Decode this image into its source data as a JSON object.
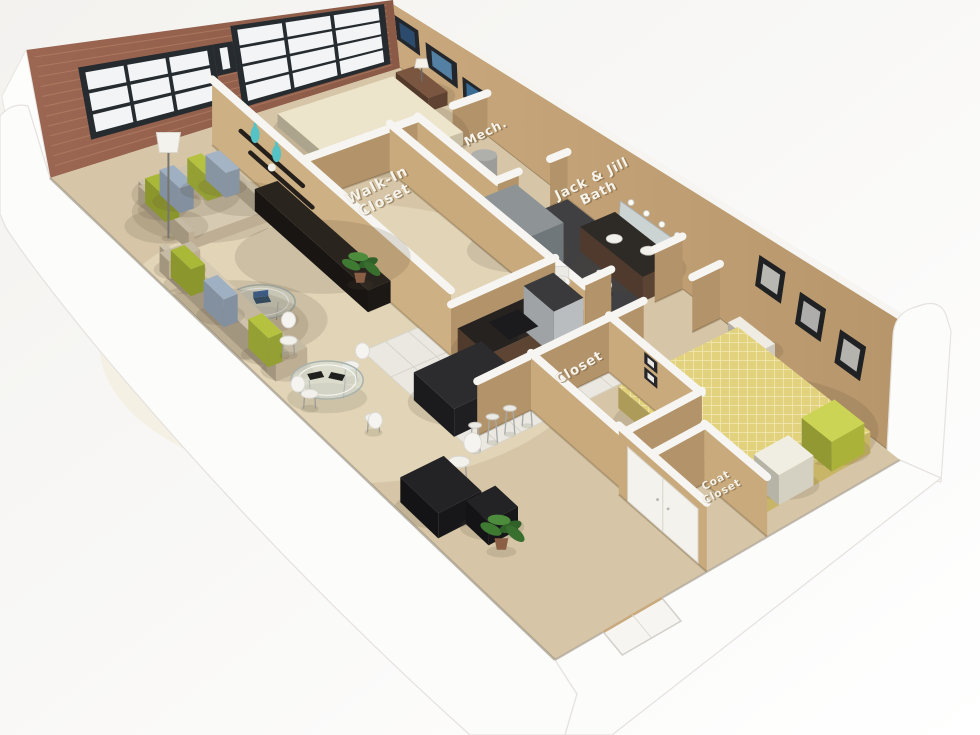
{
  "labels": [
    {
      "id": "walk-in-closet",
      "lines": [
        "Walk-In",
        "Closet"
      ],
      "u": 0.545,
      "v": 0.275,
      "rot": -27,
      "size": 14.5,
      "lift": 1.0
    },
    {
      "id": "mech",
      "lines": [
        "Mech."
      ],
      "u": 0.885,
      "v": 0.255,
      "rot": -27,
      "size": 12.5,
      "lift": 1.0
    },
    {
      "id": "jack-and-jill-bath",
      "lines": [
        "Jack & Jill",
        "Bath"
      ],
      "u": 0.96,
      "v": 0.415,
      "rot": -26,
      "size": 13.5,
      "lift": 1.05
    },
    {
      "id": "closet",
      "lines": [
        "Closet"
      ],
      "u": 0.505,
      "v": 0.705,
      "rot": -30,
      "size": 13.5,
      "lift": 1.0
    },
    {
      "id": "coat-closet",
      "lines": [
        "Coat",
        "Closet"
      ],
      "u": 0.565,
      "v": 0.935,
      "rot": -28,
      "size": 10.5,
      "lift": 0.55
    }
  ],
  "palette": {
    "bg_a": "#f3f2ef",
    "bg_b": "#ffffff",
    "brick_a": "#9c6752",
    "brick_b": "#8a5a46",
    "mortar": "rgba(193,142,112,0.45)",
    "window_frame": "#262b2f",
    "window_pane": "#f2f4f5",
    "ne_wall_a": "#c8a87c",
    "ne_wall_b": "#b6956a",
    "wall_face_light": "#c9aa7d",
    "wall_face_dark": "#b3936a",
    "wall_cap": "#f6f5f1",
    "carpet": "#d6c6a7",
    "carpet_light": "#e6d8b8",
    "tile": "#eae8e1",
    "tile_line": "#d7d4c9",
    "bath_floor": "#403f42",
    "white_band": "#fcfcfb",
    "band_edge": "#e6e3df",
    "cabinet": "#5d4433",
    "counter": "#262220",
    "steel": "#b9bdc0",
    "sofa_top": "#d6cab2",
    "sofa_side": "#bdae94",
    "pillow_green": "#a9b837",
    "pillow_gray": "#9fb0c2",
    "bed1_top": "#ece4cb",
    "bed2_top": "#e2d27e",
    "desk": "#232326",
    "plant": "#3f7a33",
    "vase_teal": "#55c2c5",
    "label_fill": "#f6f3ea",
    "label_shadow": "rgba(120,95,60,0.55)"
  },
  "corners": {
    "W": [
      50,
      178
    ],
    "N": [
      400,
      68
    ],
    "E": [
      900,
      460
    ],
    "S": [
      555,
      660
    ]
  },
  "brick_windows": [
    {
      "t1": 0.13,
      "t2": 0.5,
      "s1": 0.2,
      "s2": 0.8,
      "cols": 3,
      "rows": 3
    },
    {
      "t1": 0.555,
      "t2": 0.975,
      "s1": 0.1,
      "s2": 0.96,
      "cols": 3,
      "rows": 4
    },
    {
      "t1": 0.5,
      "t2": 0.555,
      "s1": 0.48,
      "s2": 0.8,
      "cols": 1,
      "rows": 1
    }
  ],
  "ne_art": {
    "bedroom1_frames": [
      {
        "t1": 0.0,
        "t2": 0.045,
        "s1": 0.42,
        "s2": 0.78,
        "art": "#2c4a6b"
      },
      {
        "t1": 0.058,
        "t2": 0.118,
        "s1": 0.34,
        "s2": 0.68,
        "art": "#5380a3"
      },
      {
        "t1": 0.128,
        "t2": 0.168,
        "s1": 0.28,
        "s2": 0.55,
        "art": "#3a6b92"
      }
    ],
    "bedroom2_frames": [
      {
        "t1": 0.695,
        "t2": 0.745,
        "s1": 0.5,
        "s2": 0.78,
        "art": "#b8b7b2"
      },
      {
        "t1": 0.775,
        "t2": 0.825,
        "s1": 0.42,
        "s2": 0.7,
        "art": "#aeadab"
      },
      {
        "t1": 0.855,
        "t2": 0.905,
        "s1": 0.34,
        "s2": 0.62,
        "art": "#b4b3ae"
      }
    ],
    "mirror": {
      "t1": 0.435,
      "t2": 0.555,
      "s1": 0.1,
      "s2": 0.4
    },
    "bulbs": {
      "s": 0.46,
      "t_start": 0.455,
      "t_end": 0.545,
      "count": 4
    }
  },
  "walls": [
    {
      "id": "tv-wall",
      "u1": 0.42,
      "v1": 0.03,
      "u2": 0.42,
      "v2": 0.505,
      "h": 72,
      "face": "#cdb083",
      "shelves": [
        {
          "t1": 0.12,
          "t2": 0.38,
          "s": 0.6
        },
        {
          "t1": 0.16,
          "t2": 0.42,
          "s": 0.4
        }
      ],
      "vases": [
        {
          "t": 0.18,
          "s": 0.6
        },
        {
          "t": 0.27,
          "s": 0.6
        }
      ],
      "ball": {
        "t": 0.25,
        "s": 0.4
      }
    },
    {
      "id": "bedroom1-wall-a",
      "u1": 0.42,
      "v1": 0.175,
      "u2": 0.8,
      "v2": 0.175,
      "h": 50
    },
    {
      "id": "bedroom1-wall-b",
      "u1": 0.9,
      "v1": 0.175,
      "u2": 1.0,
      "v2": 0.175,
      "h": 50
    },
    {
      "id": "mech-wall-west",
      "u1": 0.8,
      "v1": 0.175,
      "u2": 0.8,
      "v2": 0.335,
      "h": 50
    },
    {
      "id": "mech-wall-south-a",
      "u1": 0.8,
      "v1": 0.335,
      "u2": 0.86,
      "v2": 0.335,
      "h": 50
    },
    {
      "id": "mech-wall-south-b",
      "u1": 0.95,
      "v1": 0.335,
      "u2": 1.0,
      "v2": 0.335,
      "h": 50
    },
    {
      "id": "closet-wall-east",
      "u1": 0.72,
      "v1": 0.175,
      "u2": 0.72,
      "v2": 0.565,
      "h": 50
    },
    {
      "id": "kitchen-wall",
      "u1": 0.42,
      "v1": 0.505,
      "u2": 0.72,
      "v2": 0.505,
      "h": 50
    },
    {
      "id": "bath-wall-south-a",
      "u1": 0.72,
      "v1": 0.565,
      "u2": 0.795,
      "v2": 0.565,
      "h": 50
    },
    {
      "id": "bath-wall-south-b",
      "u1": 0.92,
      "v1": 0.565,
      "u2": 1.0,
      "v2": 0.565,
      "h": 50
    },
    {
      "id": "hall-stub-wall",
      "u1": 0.3,
      "v1": 0.64,
      "u2": 0.455,
      "v2": 0.64,
      "h": 50
    },
    {
      "id": "hall-closet-wall-north",
      "u1": 0.455,
      "v1": 0.64,
      "u2": 0.68,
      "v2": 0.64,
      "h": 50
    },
    {
      "id": "hall-closet-wall-east",
      "u1": 0.68,
      "v1": 0.64,
      "u2": 0.68,
      "v2": 0.825,
      "h": 50,
      "frames": [
        {
          "t1": 0.38,
          "t2": 0.52,
          "s1": 0.42,
          "s2": 0.62
        },
        {
          "t1": 0.38,
          "t2": 0.52,
          "s1": 0.68,
          "s2": 0.88
        }
      ]
    },
    {
      "id": "hall-closet-wall-west",
      "u1": 0.455,
      "v1": 0.64,
      "u2": 0.455,
      "v2": 0.825,
      "h": 50
    },
    {
      "id": "hall-closet-wall-south",
      "u1": 0.455,
      "v1": 0.825,
      "u2": 0.68,
      "v2": 0.825,
      "h": 50
    },
    {
      "id": "bedroom2-wall-north-a",
      "u1": 0.68,
      "v1": 0.64,
      "u2": 0.78,
      "v2": 0.64,
      "h": 50
    },
    {
      "id": "bedroom2-wall-north-b",
      "u1": 0.92,
      "v1": 0.64,
      "u2": 1.0,
      "v2": 0.64,
      "h": 50
    },
    {
      "id": "bedroom2-wall-west",
      "u1": 0.44,
      "v1": 0.825,
      "u2": 0.44,
      "v2": 1.0,
      "h": 56,
      "doors": "double"
    },
    {
      "id": "coat-closet-wall-north",
      "u1": 0.46,
      "v1": 0.875,
      "u2": 0.615,
      "v2": 0.875,
      "h": 48
    },
    {
      "id": "coat-closet-wall-east",
      "u1": 0.615,
      "v1": 0.875,
      "u2": 0.615,
      "v2": 1.0,
      "h": 48
    }
  ],
  "furniture": [
    {
      "id": "bed1",
      "type": "box",
      "u1": 0.6,
      "v1": 0.035,
      "u2": 0.93,
      "v2": 0.175,
      "h": 16,
      "top": "#ece4cb",
      "side": "#c9bfa4"
    },
    {
      "id": "bed1-pillow-a",
      "type": "box",
      "u1": 0.845,
      "v1": 0.045,
      "u2": 0.915,
      "v2": 0.1,
      "h": 22,
      "top": "#b8c63d",
      "side": "#9aa82e"
    },
    {
      "id": "bed1-pillow-b",
      "type": "box",
      "u1": 0.845,
      "v1": 0.11,
      "u2": 0.915,
      "v2": 0.165,
      "h": 22,
      "top": "#cdd34f",
      "side": "#aab23a"
    },
    {
      "id": "nightstand1",
      "type": "box",
      "u1": 0.945,
      "v1": 0.03,
      "u2": 1.0,
      "v2": 0.095,
      "h": 17,
      "top": "#7a5640",
      "side": "#5f4231",
      "lampTop": true
    },
    {
      "id": "tv-console",
      "type": "box",
      "u1": 0.355,
      "v1": 0.16,
      "u2": 0.42,
      "v2": 0.385,
      "h": 24,
      "top": "#2a241f",
      "side": "#1c1815"
    },
    {
      "id": "console-ball",
      "type": "flatCircle",
      "u": 0.4,
      "v": 0.19,
      "r": 4.5,
      "liftpx": 30,
      "fill": "#f2f0ea"
    },
    {
      "id": "sofa-long",
      "type": "sofa",
      "u1": 0.13,
      "v1": 0.085,
      "u2": 0.37,
      "v2": 0.185,
      "h": 14,
      "backside": "v1",
      "top": "#d6cab2",
      "side": "#bdae94",
      "pillows": [
        {
          "u": 0.165,
          "v": 0.108,
          "c": "#a9b837"
        },
        {
          "u": 0.215,
          "v": 0.102,
          "c": "#9fb0c2"
        },
        {
          "u": 0.3,
          "v": 0.098,
          "c": "#b4c23f"
        },
        {
          "u": 0.345,
          "v": 0.103,
          "c": "#a5b4c4"
        }
      ]
    },
    {
      "id": "sofa-side",
      "type": "sofa",
      "u1": 0.025,
      "v1": 0.2,
      "u2": 0.115,
      "v2": 0.43,
      "h": 14,
      "backside": "u1",
      "top": "#d6cab2",
      "side": "#bdae94",
      "pillows": [
        {
          "u": 0.055,
          "v": 0.235,
          "c": "#a9b837"
        },
        {
          "u": 0.055,
          "v": 0.3,
          "c": "#9fb0c2"
        },
        {
          "u": 0.06,
          "v": 0.385,
          "c": "#b4c23f"
        }
      ]
    },
    {
      "id": "floor-lamp",
      "type": "lamp",
      "u": 0.115,
      "v": 0.155
    },
    {
      "id": "coffee-table",
      "type": "glassRound",
      "u": 0.135,
      "v": 0.325,
      "rx": 34,
      "ry": 17,
      "laptop": true
    },
    {
      "id": "living-plant",
      "type": "plant",
      "u": 0.405,
      "v": 0.335,
      "s": 1.0
    },
    {
      "id": "dining-table",
      "type": "glassRound",
      "u": 0.1,
      "v": 0.48,
      "rx": 36,
      "ry": 19,
      "mats": true
    },
    {
      "id": "dining-chair-n",
      "type": "chair",
      "u": 0.105,
      "v": 0.4,
      "back": [
        0,
        -14
      ]
    },
    {
      "id": "dining-chair-e",
      "type": "chair",
      "u": 0.175,
      "v": 0.475,
      "back": [
        13,
        -7
      ]
    },
    {
      "id": "dining-chair-s",
      "type": "chair",
      "u": 0.11,
      "v": 0.565,
      "back": [
        2,
        12
      ]
    },
    {
      "id": "dining-chair-w",
      "type": "chair",
      "u": 0.035,
      "v": 0.49,
      "back": [
        -13,
        -2
      ]
    },
    {
      "id": "kitchen-cabinets",
      "type": "box",
      "u1": 0.425,
      "v1": 0.515,
      "u2": 0.7,
      "v2": 0.575,
      "h": 30,
      "top": "#262220",
      "side": "#5d4433",
      "k": -0.05
    },
    {
      "id": "oven-tower",
      "type": "box",
      "u1": 0.615,
      "v1": 0.515,
      "u2": 0.7,
      "v2": 0.575,
      "h": 42,
      "top": "#3a3a3c",
      "side": "#b9bdc0",
      "k": -0.045
    },
    {
      "id": "cooktop",
      "type": "flatQuad",
      "u1": 0.5,
      "v1": 0.525,
      "u2": 0.585,
      "v2": 0.565,
      "liftpx": 30,
      "fill": "#1b1b1d",
      "k": -0.04
    },
    {
      "id": "island-bar",
      "type": "box",
      "u1": 0.255,
      "v1": 0.545,
      "u2": 0.45,
      "v2": 0.625,
      "h": 26,
      "top": "#2c2c2f",
      "side": "#1f1f22"
    },
    {
      "id": "stool-1",
      "type": "stool",
      "u": 0.265,
      "v": 0.66
    },
    {
      "id": "stool-2",
      "type": "stool",
      "u": 0.315,
      "v": 0.66
    },
    {
      "id": "stool-3",
      "type": "stool",
      "u": 0.365,
      "v": 0.66
    },
    {
      "id": "stool-4",
      "type": "stool",
      "u": 0.415,
      "v": 0.66
    },
    {
      "id": "shower",
      "type": "box",
      "u1": 0.725,
      "v1": 0.34,
      "u2": 0.845,
      "v2": 0.435,
      "h": 40,
      "top": "#8e9496",
      "side": "#70777a"
    },
    {
      "id": "toilet-1",
      "type": "toilet",
      "u": 0.775,
      "v": 0.48
    },
    {
      "id": "toilet-2",
      "type": "toilet",
      "u": 0.845,
      "v": 0.515
    },
    {
      "id": "bath-vanity",
      "type": "box",
      "u1": 0.9,
      "v1": 0.43,
      "u2": 1.0,
      "v2": 0.555,
      "h": 24,
      "top": "#2e2a26",
      "side": "#5c4434",
      "sinks": true
    },
    {
      "id": "water-heater",
      "type": "cyl",
      "u": 0.89,
      "v": 0.245,
      "r": 13,
      "h": 26,
      "fill": "#9c9c9a"
    },
    {
      "id": "bed2",
      "type": "box",
      "u1": 0.62,
      "v1": 0.7,
      "u2": 0.965,
      "v2": 0.965,
      "h": 18,
      "top": "pattern",
      "side": "#c9b568"
    },
    {
      "id": "bed2-pillow-a",
      "type": "box",
      "u1": 0.86,
      "v1": 0.9,
      "u2": 0.955,
      "v2": 0.96,
      "h": 24,
      "top": "#ccd455",
      "side": "#aab23a",
      "k": 0.2
    },
    {
      "id": "bed2-pillow-b",
      "type": "box",
      "u1": 0.7,
      "v1": 0.915,
      "u2": 0.8,
      "v2": 0.965,
      "h": 24,
      "top": "#f0eee2",
      "side": "#d4d1c2",
      "k": 0.2
    },
    {
      "id": "nightstand2",
      "type": "box",
      "u1": 0.965,
      "v1": 0.68,
      "u2": 1.0,
      "v2": 0.75,
      "h": 16,
      "top": "#efece4",
      "side": "#cfc9bd"
    },
    {
      "id": "desk",
      "type": "box",
      "u1": 0.02,
      "v1": 0.68,
      "u2": 0.145,
      "v2": 0.755,
      "h": 22,
      "top": "#232326",
      "side": "#17171a"
    },
    {
      "id": "desk-return",
      "type": "box",
      "u1": 0.1,
      "v1": 0.755,
      "u2": 0.185,
      "v2": 0.8,
      "h": 20,
      "top": "#232326",
      "side": "#17171a"
    },
    {
      "id": "desk-chair",
      "type": "chair",
      "u": 0.175,
      "v": 0.69,
      "back": [
        12,
        -8
      ],
      "big": true
    },
    {
      "id": "desk-plant",
      "type": "plant",
      "u": 0.115,
      "v": 0.815,
      "s": 1.15
    }
  ]
}
